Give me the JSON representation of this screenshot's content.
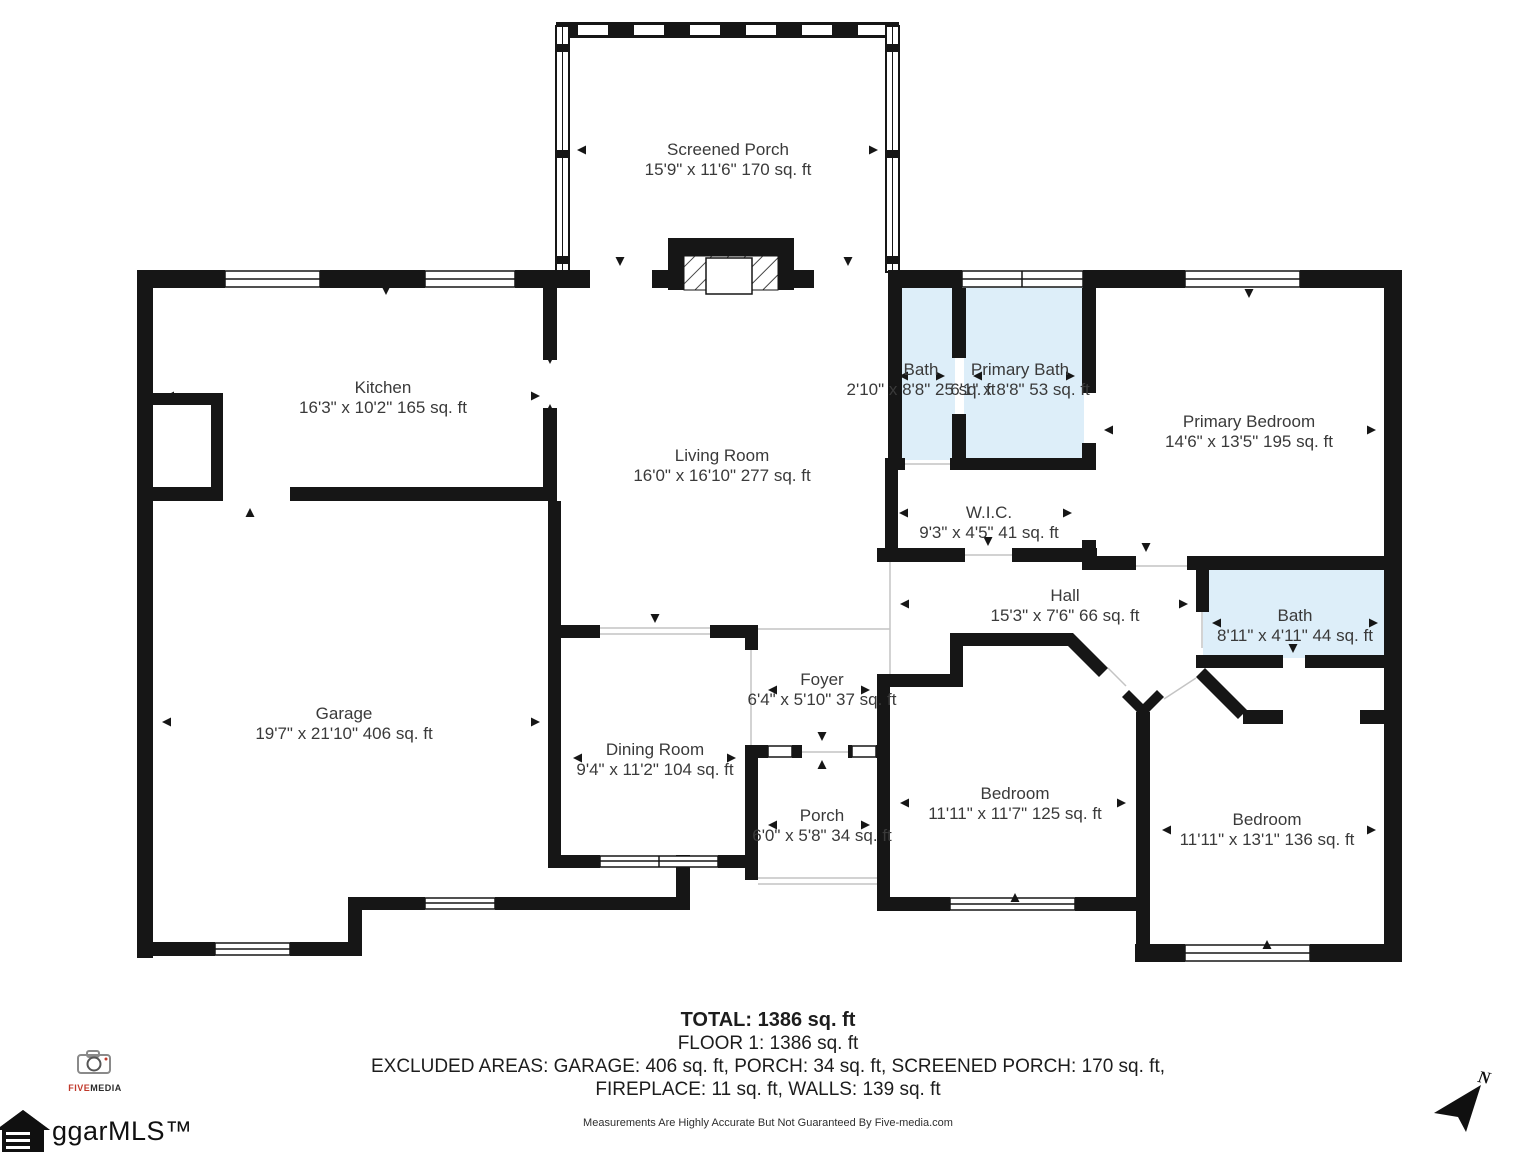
{
  "rooms": {
    "screened_porch": {
      "name": "Screened Porch",
      "dims": "15'9\" x 11'6\" 170 sq. ft"
    },
    "kitchen": {
      "name": "Kitchen",
      "dims": "16'3\" x 10'2\" 165 sq. ft"
    },
    "living_room": {
      "name": "Living Room",
      "dims": "16'0\" x 16'10\" 277 sq. ft"
    },
    "bath_top": {
      "name": "Bath",
      "dims": "2'10\" x 8'8\" 25 sq. ft"
    },
    "primary_bath": {
      "name": "Primary Bath",
      "dims": "6'1\" x 8'8\" 53 sq. ft"
    },
    "primary_bedroom": {
      "name": "Primary Bedroom",
      "dims": "14'6\" x 13'5\" 195 sq. ft"
    },
    "wic": {
      "name": "W.I.C.",
      "dims": "9'3\" x 4'5\" 41 sq. ft"
    },
    "hall": {
      "name": "Hall",
      "dims": "15'3\" x 7'6\" 66 sq. ft"
    },
    "bath_right": {
      "name": "Bath",
      "dims": "8'11\" x 4'11\" 44 sq. ft"
    },
    "garage": {
      "name": "Garage",
      "dims": "19'7\" x 21'10\" 406 sq. ft"
    },
    "dining_room": {
      "name": "Dining Room",
      "dims": "9'4\" x 11'2\" 104 sq. ft"
    },
    "foyer": {
      "name": "Foyer",
      "dims": "6'4\" x 5'10\" 37 sq. ft"
    },
    "porch": {
      "name": "Porch",
      "dims": "6'0\" x 5'8\" 34 sq. ft"
    },
    "bedroom_1": {
      "name": "Bedroom",
      "dims": "11'11\" x 11'7\" 125 sq. ft"
    },
    "bedroom_2": {
      "name": "Bedroom",
      "dims": "11'11\" x 13'1\" 136 sq. ft"
    }
  },
  "summary": {
    "total": "TOTAL: 1386 sq. ft",
    "floor": "FLOOR 1: 1386 sq. ft",
    "excluded_line1": "EXCLUDED AREAS: GARAGE: 406 sq. ft, PORCH: 34 sq. ft, SCREENED PORCH: 170 sq. ft,",
    "excluded_line2": "FIREPLACE: 11 sq. ft, WALLS: 139 sq. ft",
    "disclaimer": "Measurements Are Highly Accurate But Not Guaranteed By Five-media.com"
  },
  "branding": {
    "photographer_word_red": "FIVE",
    "photographer_word_dark": "MEDIA",
    "mls_text": "ggarMLS™",
    "compass_label": "N"
  },
  "colors": {
    "wall": "#161616",
    "bath_fill": "#ddeef9",
    "text": "#3a3a3a",
    "accent_red": "#c0392b"
  }
}
